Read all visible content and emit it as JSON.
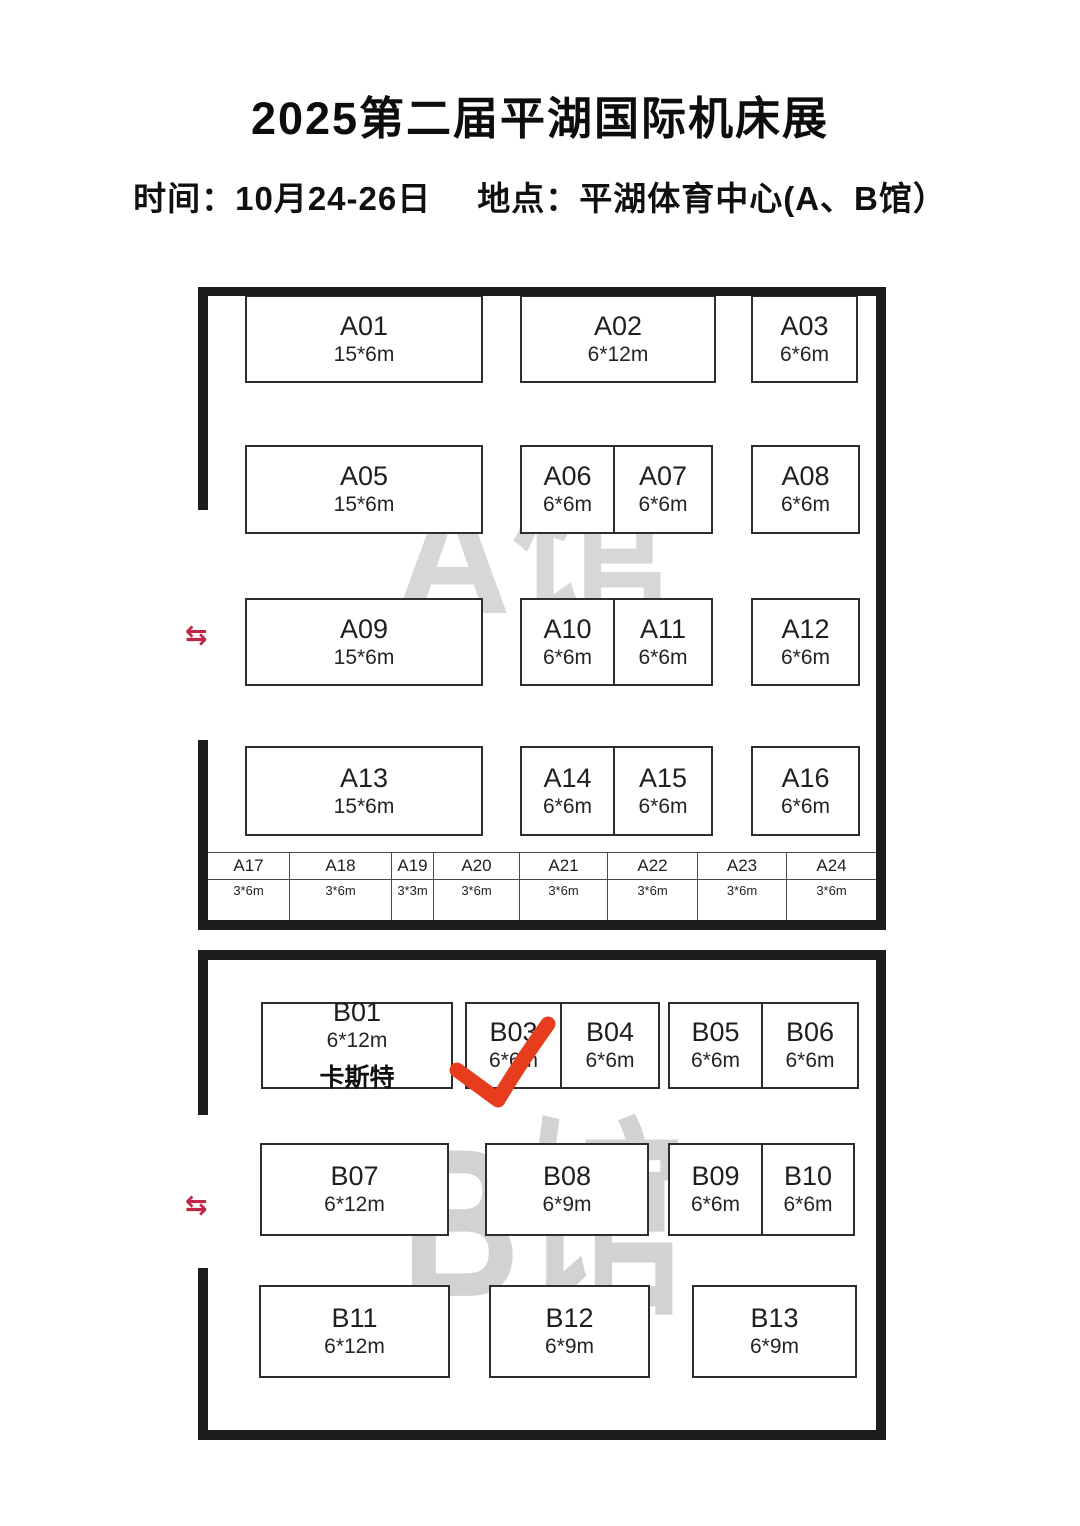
{
  "page": {
    "title": "2025第二届平湖国际机床展",
    "info_time": "时间：10月24-26日",
    "info_venue": "地点：平湖体育中心(A、B馆）"
  },
  "colors": {
    "wall": "#1d1d1d",
    "booth_border": "#2d2d2d",
    "watermark_a": "#d7d7d7",
    "watermark_b": "#d2d2d2",
    "entrance_arrow_red": "#c02747",
    "checkmark_red": "#e73c1d"
  },
  "icons": {
    "entrance_arrows": "⇆"
  },
  "annotation": {
    "checked_booth": "B03"
  },
  "hall_a": {
    "watermark": "A馆",
    "booths": [
      {
        "id": "A01",
        "size": "15*6m",
        "x": 47,
        "y": 8,
        "w": 238,
        "h": 88
      },
      {
        "id": "A02",
        "size": "6*12m",
        "x": 322,
        "y": 8,
        "w": 196,
        "h": 88
      },
      {
        "id": "A03",
        "size": "6*6m",
        "x": 553,
        "y": 8,
        "w": 107,
        "h": 88
      },
      {
        "id": "A05",
        "size": "15*6m",
        "x": 47,
        "y": 158,
        "w": 238,
        "h": 89
      },
      {
        "id": "A06",
        "size": "6*6m",
        "x": 322,
        "y": 158,
        "w": 95,
        "h": 89
      },
      {
        "id": "A07",
        "size": "6*6m",
        "x": 415,
        "y": 158,
        "w": 100,
        "h": 89
      },
      {
        "id": "A08",
        "size": "6*6m",
        "x": 553,
        "y": 158,
        "w": 109,
        "h": 89
      },
      {
        "id": "A09",
        "size": "15*6m",
        "x": 47,
        "y": 311,
        "w": 238,
        "h": 88
      },
      {
        "id": "A10",
        "size": "6*6m",
        "x": 322,
        "y": 311,
        "w": 95,
        "h": 88
      },
      {
        "id": "A11",
        "size": "6*6m",
        "x": 415,
        "y": 311,
        "w": 100,
        "h": 88
      },
      {
        "id": "A12",
        "size": "6*6m",
        "x": 553,
        "y": 311,
        "w": 109,
        "h": 88
      },
      {
        "id": "A13",
        "size": "15*6m",
        "x": 47,
        "y": 459,
        "w": 238,
        "h": 90
      },
      {
        "id": "A14",
        "size": "6*6m",
        "x": 322,
        "y": 459,
        "w": 95,
        "h": 90
      },
      {
        "id": "A15",
        "size": "6*6m",
        "x": 415,
        "y": 459,
        "w": 100,
        "h": 90
      },
      {
        "id": "A16",
        "size": "6*6m",
        "x": 553,
        "y": 459,
        "w": 109,
        "h": 90
      }
    ],
    "strip_booths": [
      {
        "id": "A17",
        "size": "3*6m",
        "w": 82
      },
      {
        "id": "A18",
        "size": "3*6m",
        "w": 102
      },
      {
        "id": "A19",
        "size": "3*3m",
        "w": 42
      },
      {
        "id": "A20",
        "size": "3*6m",
        "w": 86
      },
      {
        "id": "A21",
        "size": "3*6m",
        "w": 88
      },
      {
        "id": "A22",
        "size": "3*6m",
        "w": 90
      },
      {
        "id": "A23",
        "size": "3*6m",
        "w": 89
      },
      {
        "id": "A24",
        "size": "3*6m",
        "w": 89
      }
    ]
  },
  "hall_b": {
    "watermark": "B馆",
    "booths": [
      {
        "id": "B01",
        "size": "6*12m",
        "company": "卡斯特",
        "x": 63,
        "y": 52,
        "w": 192,
        "h": 87
      },
      {
        "id": "B03",
        "size": "6*6m",
        "x": 267,
        "y": 52,
        "w": 97,
        "h": 87
      },
      {
        "id": "B04",
        "size": "6*6m",
        "x": 362,
        "y": 52,
        "w": 100,
        "h": 87
      },
      {
        "id": "B05",
        "size": "6*6m",
        "x": 470,
        "y": 52,
        "w": 95,
        "h": 87
      },
      {
        "id": "B06",
        "size": "6*6m",
        "x": 563,
        "y": 52,
        "w": 98,
        "h": 87
      },
      {
        "id": "B07",
        "size": "6*12m",
        "x": 62,
        "y": 193,
        "w": 189,
        "h": 93
      },
      {
        "id": "B08",
        "size": "6*9m",
        "x": 287,
        "y": 193,
        "w": 164,
        "h": 93
      },
      {
        "id": "B09",
        "size": "6*6m",
        "x": 470,
        "y": 193,
        "w": 95,
        "h": 93
      },
      {
        "id": "B10",
        "size": "6*6m",
        "x": 563,
        "y": 193,
        "w": 94,
        "h": 93
      },
      {
        "id": "B11",
        "size": "6*12m",
        "x": 61,
        "y": 335,
        "w": 191,
        "h": 93
      },
      {
        "id": "B12",
        "size": "6*9m",
        "x": 291,
        "y": 335,
        "w": 161,
        "h": 93
      },
      {
        "id": "B13",
        "size": "6*9m",
        "x": 494,
        "y": 335,
        "w": 165,
        "h": 93
      }
    ]
  }
}
